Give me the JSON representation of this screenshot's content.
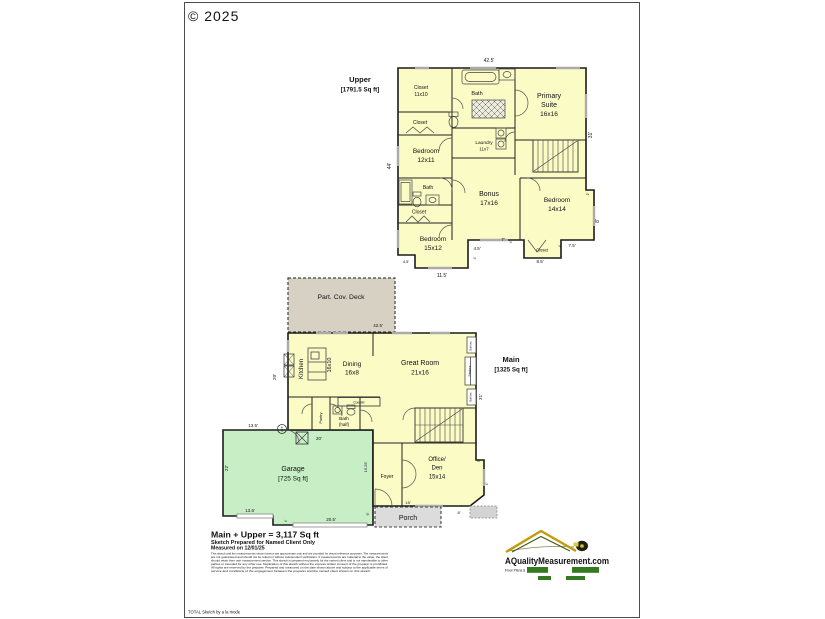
{
  "page": {
    "copyright": "© 2025",
    "branding": "TOTAL Sketch by a la mode"
  },
  "colors": {
    "floor_yellow": "#fbfbc6",
    "garage_green": "#c8eec6",
    "deck_tan": "#d6d1c3",
    "porch_gray": "#dcdcdc",
    "logo_green": "#357a21",
    "logo_gold": "#c49a0c",
    "logo_text": "#4e4e14"
  },
  "upper": {
    "title": "Upper",
    "area": "[1791.5 Sq ft]",
    "rooms": {
      "closet_a1": "Closet",
      "closet_a2": "11x10",
      "bath": "Bath",
      "primary1": "Primary",
      "primary2": "Suite",
      "primary3": "16x16",
      "closet_b": "Closet",
      "laundry1": "Laundry",
      "laundry2": "11x7",
      "bedroom_a1": "Bedroom",
      "bedroom_a2": "12x11",
      "bath_b": "Bath",
      "closet_c": "Closet",
      "bedroom_b1": "Bedroom",
      "bedroom_b2": "15x12",
      "bonus1": "Bonus",
      "bonus2": "17x16",
      "bedroom_c1": "Bedroom",
      "bedroom_c2": "14x14",
      "closet_d": "Closet"
    },
    "dims": {
      "top": "42.5'",
      "left": "44'",
      "right_top": "31'",
      "right_step": "2'",
      "right_bottom": "8'",
      "notch": "4.5'",
      "bottom_left": "11.5'",
      "mid_a": "4.5'",
      "mid_a_tick": "4'",
      "mid_b": "7'",
      "mid_b_tick": "4'",
      "closet_w": "8.5'",
      "bottom_right": "7.5'",
      "bottom_right_tick": "4'"
    }
  },
  "deck": {
    "label": "Part. Cov. Deck",
    "dim": "42.5'"
  },
  "main": {
    "title": "Main",
    "area": "[1325 Sq ft]",
    "rooms": {
      "kitchen": "Kitchen",
      "kitchen_size": "16x10",
      "dining1": "Dining",
      "dining2": "16x8",
      "great1": "Great Room",
      "great2": "21x16",
      "counter": "Counter",
      "pantry": "Pantry",
      "bath1": "Bath",
      "bath2": "(half)",
      "foyer": "Foyer",
      "office1": "Office/",
      "office2": "Den",
      "office3": "15x14",
      "porch": "Porch",
      "builtins_a": "Built-ins",
      "fireplace": "Fireplace",
      "builtins_b": "Built-ins"
    },
    "dims": {
      "left": "20'",
      "right": "31'",
      "porch": "15'",
      "bottom_right": "8'",
      "step_a": "3'",
      "step_b": "4'"
    }
  },
  "garage": {
    "label1": "Garage",
    "label2": "[725 Sq ft]",
    "dims": {
      "top": "13.5'",
      "left": "22'",
      "bottom_left": "13.5'",
      "bottom": "20.5'",
      "bottom_tick": "4'",
      "right": "15.25'",
      "right_small": "6'",
      "attic": "20'",
      "note": "1.75'"
    }
  },
  "summary": {
    "total": "Main + Upper = 3,117 Sq ft",
    "prepared_for": "Sketch Prepared for Named Client Only",
    "measured_on": "Measured on 12/01/25",
    "disclaimer": [
      "This sketch and the measurements shown hereon are approximate only and are provided for visual reference purposes. The measurements",
      "are not guaranteed and should not be relied on without independent verification. If measurements are material to the value, the client",
      "should retain their own measurement service. This sketch is prepared exclusively for the named client and is not transferable to other",
      "parties or intended for any other use. Duplication of this sketch without the express written consent of the preparer is prohibited.",
      "All rights are reserved by the preparer. Prepared and measured on the date shown above and subject to the applicable terms of",
      "service and conditions of the engagement between the preparer and the named client shown on this sketch."
    ]
  },
  "logo": {
    "name": "AQualityMeasurement.com",
    "tagline": "Floor Plans &"
  }
}
